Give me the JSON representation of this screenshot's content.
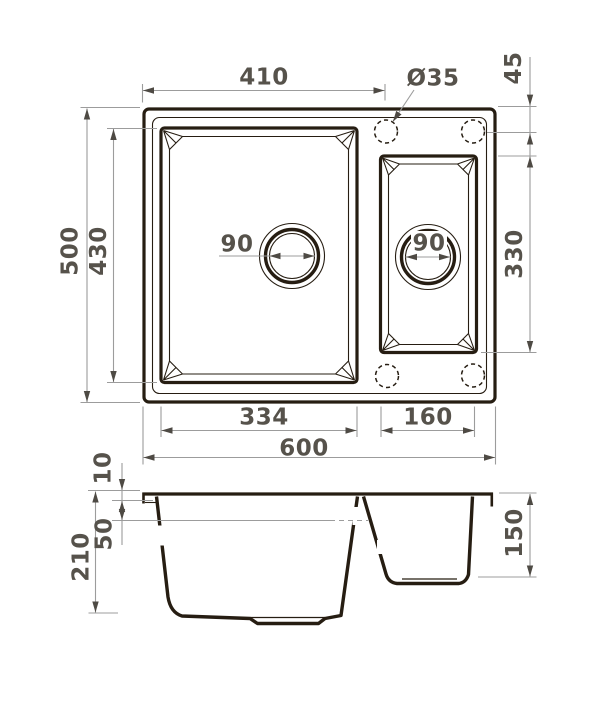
{
  "colors": {
    "ink": "#261d12",
    "dim_line": "#9c9c9c",
    "arrow": "#4e4a44",
    "dim_text": "#56524b",
    "background": "#ffffff"
  },
  "top_view": {
    "width_to_hole": "410",
    "hole_diameter": "Ø35",
    "hole_offset": "45",
    "overall_depth": "500",
    "main_bowl_depth": "430",
    "main_drain": "90",
    "small_drain": "90",
    "small_bowl_depth": "330",
    "main_bowl_width": "334",
    "small_bowl_width": "160",
    "overall_width": "600"
  },
  "section_view": {
    "rim_height": "10",
    "ledge_depth": "50",
    "main_bowl_depth": "210",
    "small_bowl_depth": "150"
  }
}
